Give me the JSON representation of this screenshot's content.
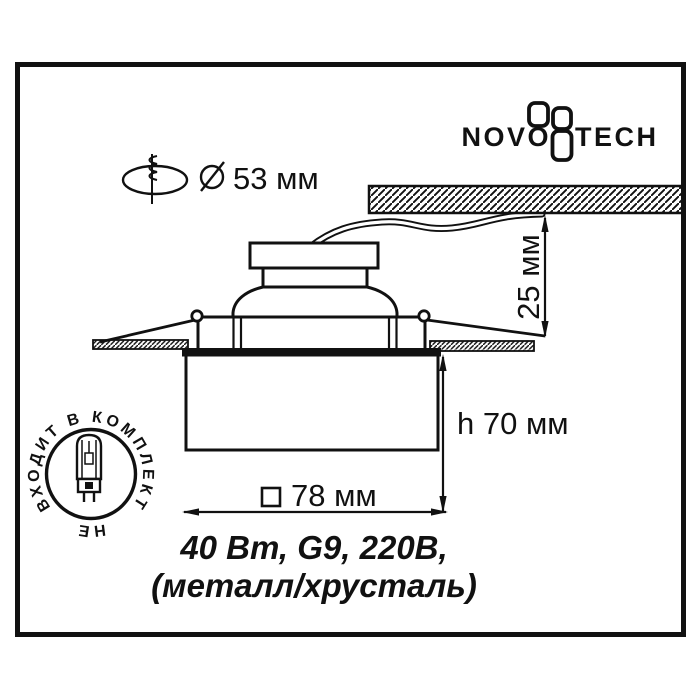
{
  "colors": {
    "ink": "#111111",
    "background": "#ffffff"
  },
  "logo": {
    "novo": "NOVO",
    "tech": "TECH"
  },
  "cutout_note": {
    "diameter_label": "53 мм"
  },
  "dimensions": {
    "recess_depth": "25 мм",
    "body_height": "h 70 мм",
    "body_width": "78 мм"
  },
  "specs": {
    "line1": "40 Вт, G9, 220В,",
    "line2": "(металл/хрусталь)"
  },
  "stamp": {
    "arc_text": "ВХОДИТ В КОМПЛЕКТ",
    "bottom_text": "НЕ"
  }
}
